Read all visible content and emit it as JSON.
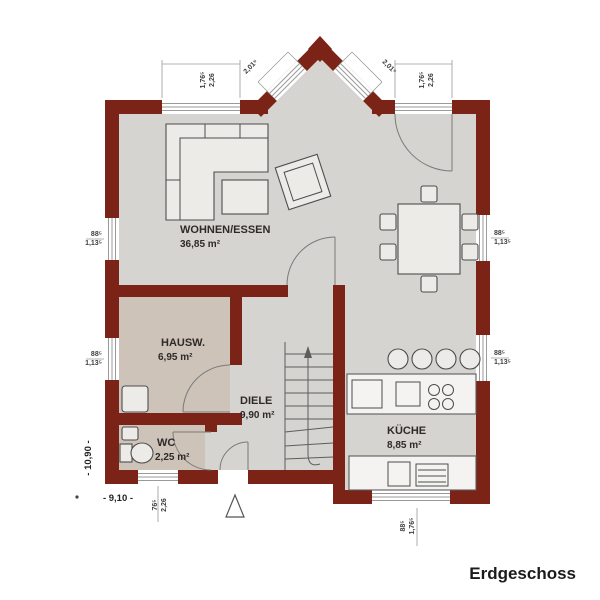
{
  "title": "Erdgeschoss",
  "plan": {
    "rooms": [
      {
        "name": "WOHNEN/ESSEN",
        "area": "36,85 m²"
      },
      {
        "name": "HAUSW.",
        "area": "6,95 m²"
      },
      {
        "name": "DIELE",
        "area": "9,90 m²"
      },
      {
        "name": "WC",
        "area": "2,25 m²"
      },
      {
        "name": "KÜCHE",
        "area": "8,85 m²"
      }
    ],
    "dimensions": {
      "overall_width": "- 9,10 -",
      "overall_height": "- 10,90 -",
      "bay_left": "2,01⁵",
      "bay_right": "2,01⁵",
      "window_top_left": [
        "1,76⁵",
        "2,26"
      ],
      "window_top_right": [
        "1,76⁵",
        "2,26"
      ],
      "window_left_upper": [
        "88⁵",
        "1,13⁵"
      ],
      "window_left_lower": [
        "88⁵",
        "1,13⁵"
      ],
      "window_right_upper": [
        "88⁵",
        "1,13⁵"
      ],
      "window_right_lower": [
        "88⁵",
        "1,13⁵"
      ],
      "window_wc": [
        "76⁵",
        "2,26"
      ],
      "window_kitchen": [
        "88⁵",
        "1,76⁵"
      ]
    },
    "colors": {
      "wall": "#7b2316",
      "floor": "#d6d4d1",
      "floor_service": "#cdc3b9"
    }
  }
}
